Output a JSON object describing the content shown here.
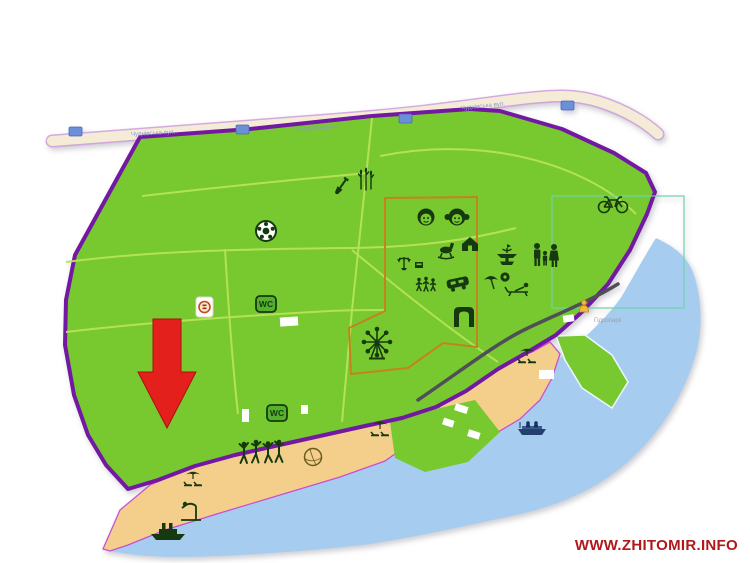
{
  "page": {
    "description": "Park and hydropark map with beaches and river",
    "background": "#ffffff"
  },
  "labels": {
    "watermark": "WWW.ZHITOMIR.INFO",
    "wc": "WC",
    "street_1": "Чуднівська вул.",
    "street_2": "Чуднівська вул.",
    "street_3": "Чуднівська вул.",
    "poi": "Гідропарк"
  },
  "colors": {
    "park_green": "#77c92f",
    "path_green": "#b9e35c",
    "border_purple": "#7318a2",
    "beach_outline_magenta": "#c94fd0",
    "sand": "#f4cf8b",
    "water": "#a6cdf0",
    "zone_orange": "#c58220",
    "zone_teal": "#70d1a9",
    "road_fill": "#f5ecd8",
    "road_edge": "#cf9ddb",
    "road_dark": "#4f4f57",
    "icon_dark": "#16390f",
    "arrow_red": "#e3201b",
    "shield_blue": "#6b8fd8",
    "wc_green": "#55b02c",
    "watermark_red": "#b0181c"
  },
  "icons": [
    "soccer-ball",
    "monument-shovel",
    "reeds",
    "bicycle",
    "boy-face",
    "girl-face",
    "carousel-horse",
    "house",
    "scales",
    "kiosk",
    "children-walking",
    "bumper-car",
    "entrance-arch",
    "ferris-wheel",
    "fountain",
    "family",
    "umbrella",
    "sun-lounger",
    "pool",
    "wc-sign",
    "wc-sign",
    "food-point",
    "local-poi",
    "red-arrow-marker",
    "beach-umbrella",
    "beach-umbrella",
    "beach-umbrella",
    "dancers",
    "volleyball",
    "diving-platform",
    "ship",
    "pleasure-boat",
    "road-shield",
    "road-shield",
    "road-shield",
    "road-shield"
  ]
}
